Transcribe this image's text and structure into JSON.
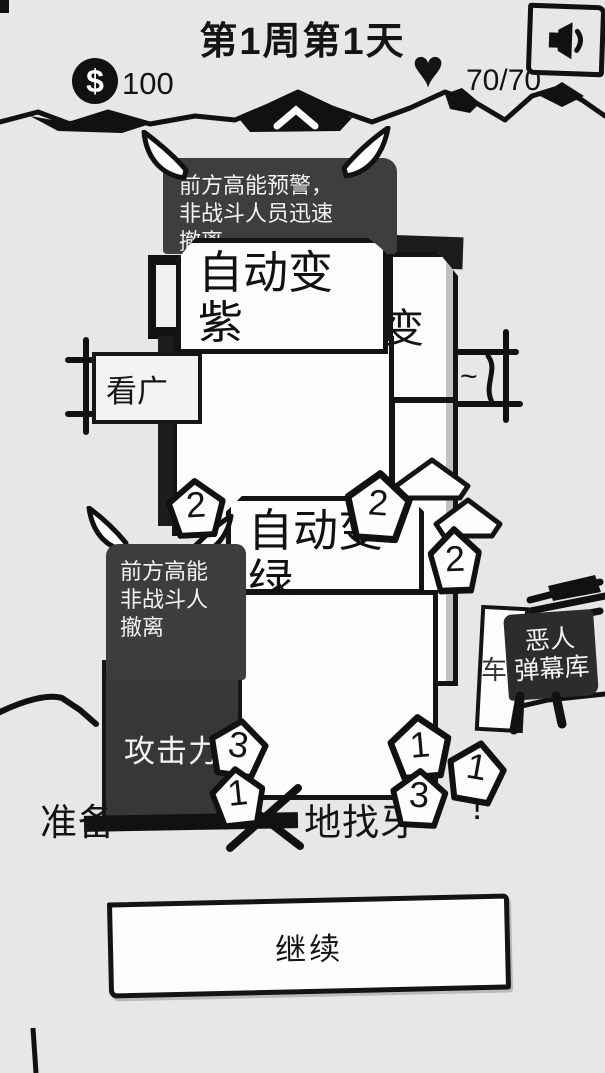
{
  "header": {
    "title": "第1周第1天",
    "money_symbol": "$",
    "money": "100",
    "heart_icon": "♥",
    "health": "70/70"
  },
  "tooltip_top": {
    "lines": [
      "前方高能预警，",
      "非战斗人员迅速",
      "撤离"
    ]
  },
  "tooltip_left": {
    "lines": [
      "前方高能",
      "非战斗人",
      "撤离"
    ]
  },
  "buildings": {
    "auto_purple_label": "自动变紫",
    "auto_green_label": "自动变绿",
    "partial_bian": "变",
    "watch_ad_label": "看广",
    "tilde": "~",
    "attack_label": "攻击力",
    "partial_che": "车",
    "enemy_barrage": {
      "lines": [
        "恶人",
        "弹幕库"
      ]
    }
  },
  "badges": {
    "green_left": "2",
    "green_mid": "2",
    "green_right": "2",
    "attack_top": "3",
    "attack_bottom": "1",
    "bottom_left": "1",
    "bottom_mid": "3",
    "bottom_right": "1"
  },
  "caption": {
    "part1": "准备",
    "part2": "地找牙",
    "part3": "!"
  },
  "continue_label": "继续",
  "colors": {
    "background": "#e8e6e7",
    "ink": "#141414",
    "dark_building": "#383737",
    "bubble_shadow": "#9e9c9d"
  }
}
